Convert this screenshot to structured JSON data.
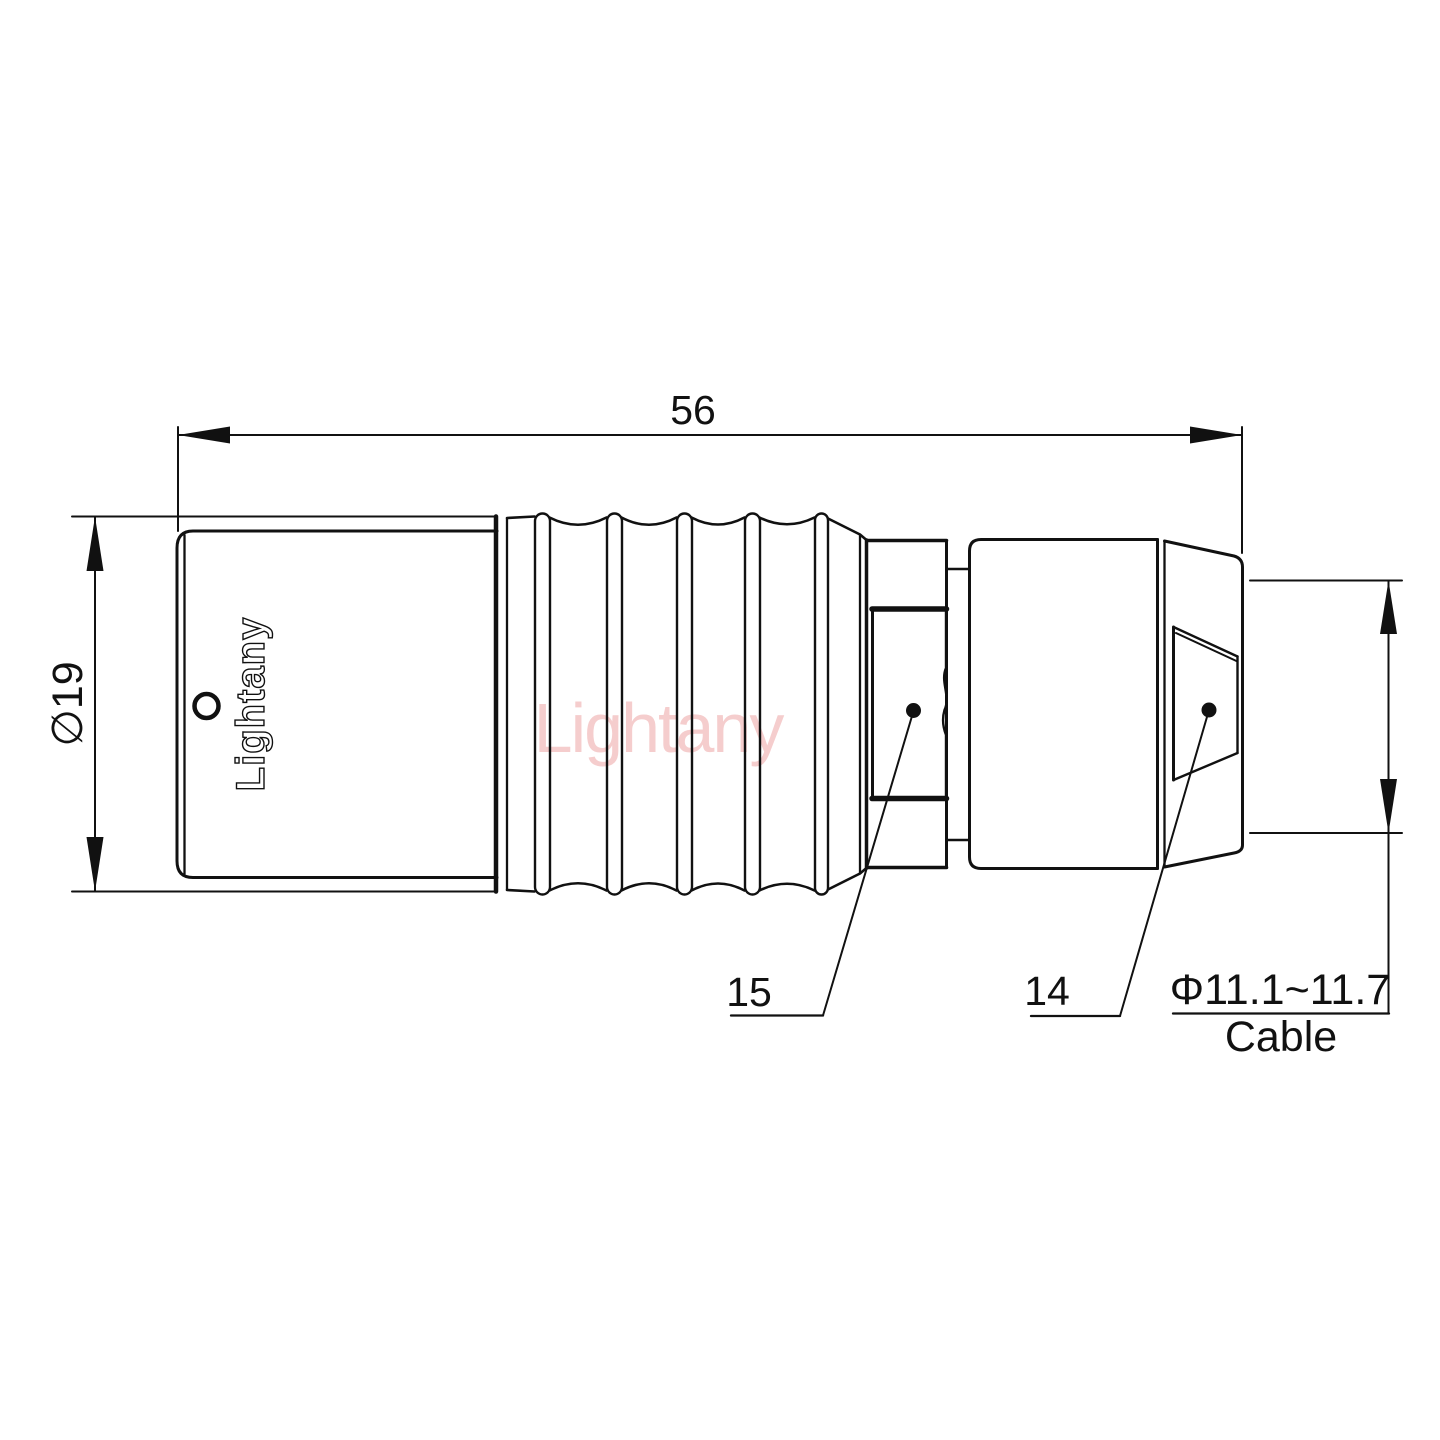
{
  "drawing": {
    "brand_logo": "Lightany",
    "watermark": "Lightany",
    "colors": {
      "line": "#111111",
      "watermark": "#eda5a5",
      "background": "#ffffff"
    },
    "dimensions": {
      "overall_length": "56",
      "body_diameter": "∅19",
      "cable_diameter": "Φ11.1~11.7",
      "cable_caption": "Cable"
    },
    "callouts": {
      "part_15": "15",
      "part_14": "14"
    }
  }
}
